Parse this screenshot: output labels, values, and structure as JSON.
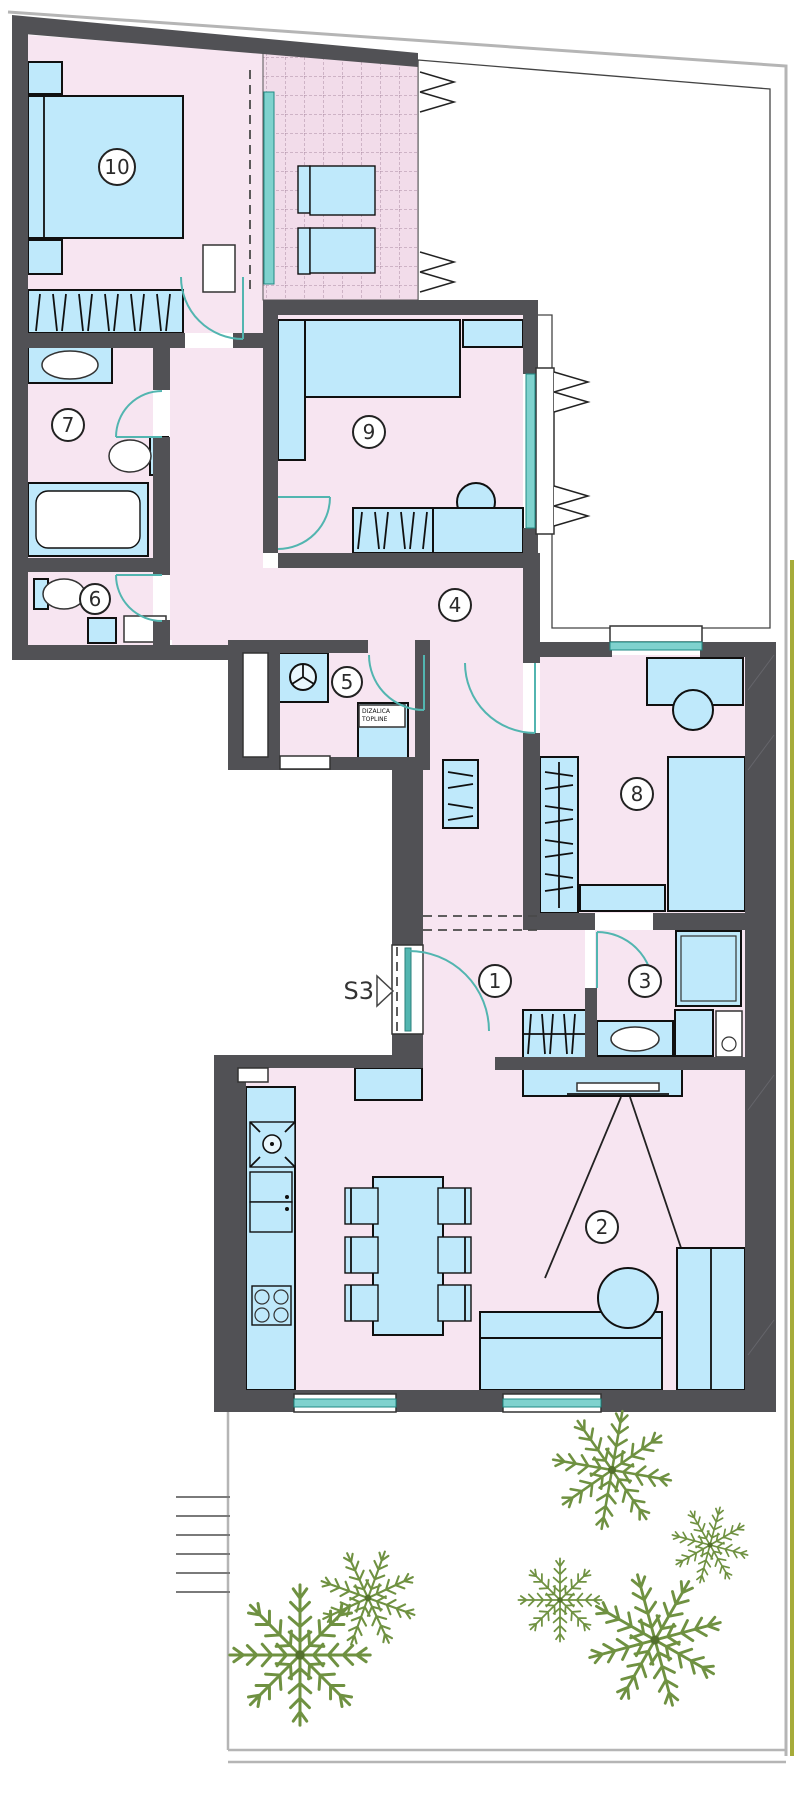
{
  "colors": {
    "wall": "#515155",
    "floor": "#f7e5f1",
    "tile-floor": "#f2dcea",
    "tile-line": "#ab8aa2",
    "furniture": "#bfe9fb",
    "furniture-stroke": "#101010",
    "door": "#52b5b0",
    "glass": "#7fd2ce",
    "plant": "#6f9141",
    "plant-dark": "#53702c",
    "boundary": "#b5b5b5",
    "olive": "#a6ab3a",
    "label": "#2b2b2b"
  },
  "floorplan": {
    "unit_label": "S3",
    "rooms": [
      {
        "number": "1"
      },
      {
        "number": "2"
      },
      {
        "number": "3"
      },
      {
        "number": "4"
      },
      {
        "number": "5"
      },
      {
        "number": "6"
      },
      {
        "number": "7"
      },
      {
        "number": "8"
      },
      {
        "number": "9"
      },
      {
        "number": "10"
      }
    ],
    "equipment_label": {
      "line1": "DIZALICA",
      "line2": "TOPLINE"
    }
  },
  "icons": {
    "entry_arrow": "triangle-right-icon",
    "washing_machine": "washing-machine-icon",
    "stove": "cooktop-icon",
    "plants": "fern-plant-icon"
  }
}
